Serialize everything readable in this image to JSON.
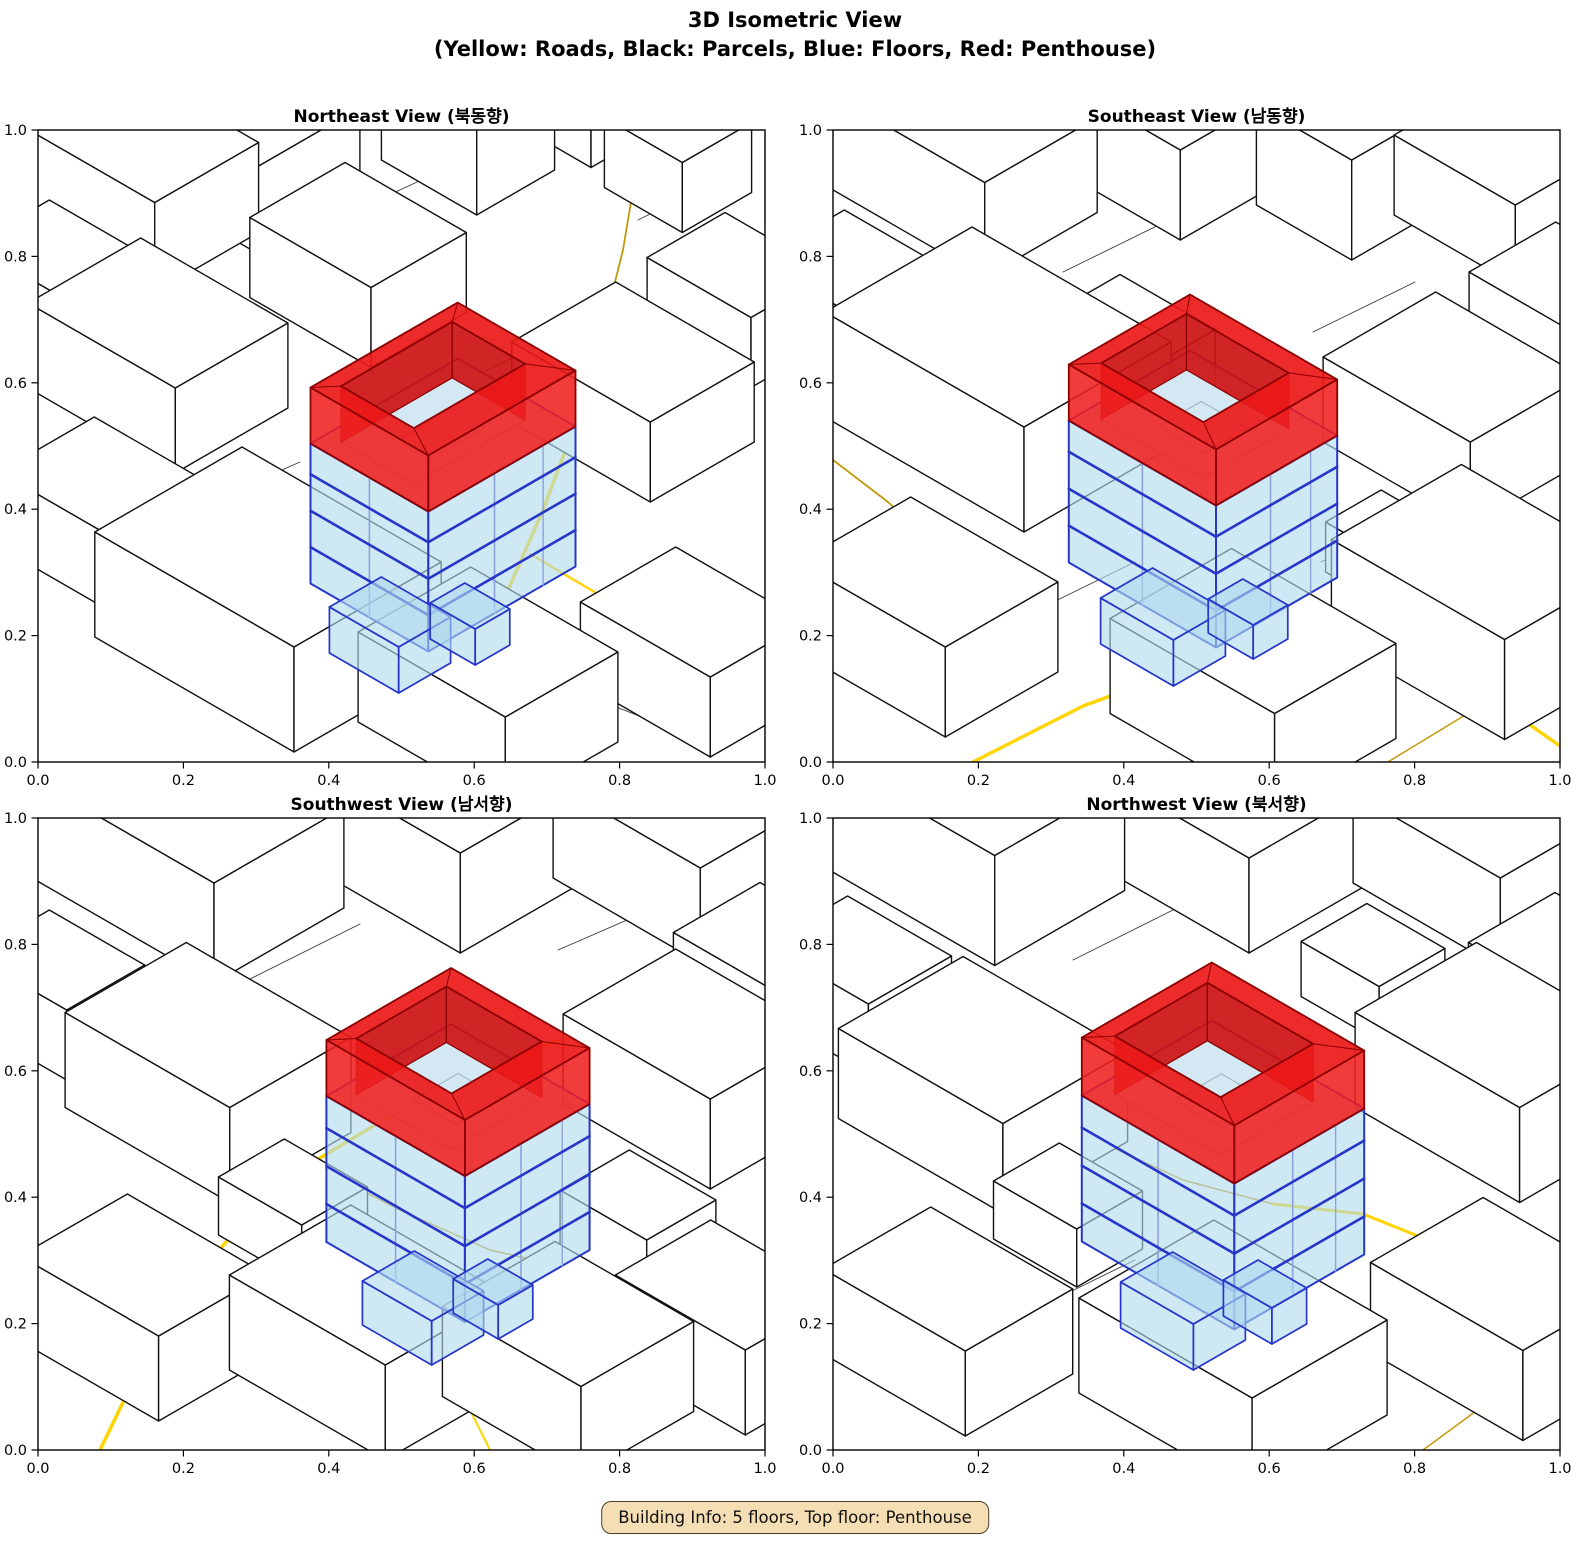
{
  "figure": {
    "title_line1": "3D Isometric View",
    "title_line2": "(Yellow: Roads, Black: Parcels, Blue: Floors, Red: Penthouse)",
    "info_box": "Building Info: 5 floors, Top floor: Penthouse"
  },
  "axes": {
    "x_ticks": [
      "0.0",
      "0.2",
      "0.4",
      "0.6",
      "0.8",
      "1.0"
    ],
    "y_ticks": [
      "0.0",
      "0.2",
      "0.4",
      "0.6",
      "0.8",
      "1.0"
    ]
  },
  "colors": {
    "bright_road": "#FFD400",
    "dark_road": "#C3990B",
    "parcel_line": "#3a3a3a",
    "building_fill": "#ffffff",
    "building_edge": "#111111",
    "blue_fill": "rgba(176,218,238,0.62)",
    "blue_top_fill": "rgba(199,228,242,0.75)",
    "blue_edge": "#2636C8",
    "blue_edge_light": "#8CA2DC",
    "hole_floor": "#D4E8F4",
    "interior_line": "#9AB0BF",
    "red_top": "rgba(235,25,25,0.92)",
    "red_wall": "rgba(240,32,32,0.88)",
    "red_inner": "rgba(205,18,18,0.92)",
    "red_edge": "#8B0000",
    "gray_arc": "#888888",
    "axis": "#000000",
    "info_bg": "#F5DEB3"
  },
  "views": [
    {
      "id": "ne",
      "title": "Northeast View (북동향)",
      "gray_arc": [
        [
          50,
          10
        ],
        [
          160,
          2
        ],
        [
          265,
          14
        ]
      ],
      "parcels": [
        [
          [
            250,
            112
          ],
          [
            392,
            46
          ]
        ],
        [
          [
            445,
            242
          ],
          [
            562,
            186
          ]
        ],
        [
          [
            150,
            382
          ],
          [
            262,
            332
          ]
        ],
        [
          [
            540,
            562
          ],
          [
            642,
            602
          ]
        ],
        [
          [
            600,
            90
          ],
          [
            660,
            60
          ]
        ]
      ],
      "roads": [
        {
          "c": "dark",
          "w": 1.8,
          "pts": [
            [
              600,
              30
            ],
            [
              585,
              120
            ],
            [
              560,
              220
            ],
            [
              535,
              300
            ]
          ]
        },
        {
          "c": "bright",
          "w": 3.5,
          "pts": [
            [
              535,
              300
            ],
            [
              505,
              380
            ],
            [
              470,
              460
            ],
            [
              435,
              540
            ],
            [
              405,
              610
            ],
            [
              392,
              632
            ]
          ]
        },
        {
          "c": "bright",
          "w": 2.4,
          "pts": [
            [
              492,
              424
            ],
            [
              570,
              470
            ],
            [
              660,
              516
            ],
            [
              727,
              546
            ]
          ]
        },
        {
          "c": "bright",
          "w": 2.4,
          "pts": [
            [
              24,
              14
            ],
            [
              58,
              52
            ]
          ]
        }
      ],
      "prisms": [
        [
          540,
          -15,
          60,
          45,
          80
        ],
        [
          205,
          55,
          75,
          60,
          85
        ],
        [
          95,
          90,
          85,
          60,
          90
        ],
        [
          430,
          35,
          55,
          45,
          95
        ],
        [
          640,
          60,
          45,
          40,
          70
        ],
        [
          320,
          175,
          70,
          55,
          80
        ],
        [
          20,
          185,
          55,
          45,
          65
        ],
        [
          700,
          205,
          60,
          45,
          70
        ],
        [
          120,
          268,
          85,
          65,
          85
        ],
        [
          595,
          302,
          80,
          60,
          80
        ],
        [
          65,
          422,
          65,
          55,
          75
        ],
        [
          230,
          522,
          115,
          85,
          105
        ],
        [
          450,
          602,
          85,
          65,
          90
        ],
        [
          655,
          562,
          75,
          55,
          80
        ]
      ],
      "building": {
        "g": [
          405,
          445
        ],
        "a": 68,
        "b": 85,
        "blueH": 140,
        "ringH": 56,
        "inset": 26,
        "holeOff": [
          -10,
          -4
        ],
        "floors": [
          0.26,
          0.52,
          0.78
        ],
        "annexes": [
          [
            352,
            528,
            40,
            30,
            46
          ],
          [
            432,
            512,
            26,
            20,
            36
          ]
        ]
      }
    },
    {
      "id": "se",
      "title": "Southeast View (남동향)",
      "parcels": [
        [
          [
            230,
            142
          ],
          [
            332,
            92
          ]
        ],
        [
          [
            480,
            202
          ],
          [
            582,
            152
          ]
        ],
        [
          [
            200,
            482
          ],
          [
            302,
            432
          ]
        ],
        [
          [
            488,
            432
          ],
          [
            562,
            396
          ]
        ]
      ],
      "roads": [
        {
          "c": "bright",
          "w": 3.0,
          "pts": [
            [
              350,
              6
            ],
            [
              480,
              32
            ],
            [
              610,
              48
            ],
            [
              727,
              52
            ]
          ]
        },
        {
          "c": "dark",
          "w": 1.8,
          "pts": [
            [
              0,
              330
            ],
            [
              55,
              372
            ],
            [
              115,
              426
            ],
            [
              170,
              482
            ]
          ]
        },
        {
          "c": "bright",
          "w": 3.4,
          "pts": [
            [
              140,
              632
            ],
            [
              250,
              576
            ],
            [
              370,
              532
            ],
            [
              480,
              516
            ],
            [
              580,
              532
            ],
            [
              670,
              576
            ],
            [
              727,
              616
            ]
          ]
        },
        {
          "c": "dark",
          "w": 1.5,
          "pts": [
            [
              555,
              632
            ],
            [
              670,
              562
            ],
            [
              727,
              536
            ]
          ]
        }
      ],
      "prisms": [
        [
          330,
          45,
          75,
          55,
          90
        ],
        [
          130,
          70,
          90,
          65,
          95
        ],
        [
          510,
          80,
          55,
          45,
          100
        ],
        [
          665,
          95,
          70,
          50,
          80
        ],
        [
          20,
          205,
          60,
          50,
          70
        ],
        [
          300,
          252,
          55,
          40,
          60
        ],
        [
          740,
          232,
          70,
          50,
          80
        ],
        [
          165,
          302,
          115,
          85,
          105
        ],
        [
          620,
          322,
          85,
          65,
          85
        ],
        [
          555,
          446,
          40,
          32,
          50
        ],
        [
          650,
          522,
          100,
          75,
          100
        ],
        [
          95,
          532,
          85,
          65,
          90
        ],
        [
          420,
          596,
          95,
          70,
          95
        ]
      ],
      "building": {
        "g": [
          370,
          440
        ],
        "a": 85,
        "b": 70,
        "blueH": 142,
        "ringH": 56,
        "inset": 26,
        "holeOff": [
          -8,
          -4
        ],
        "floors": [
          0.26,
          0.52,
          0.78
        ],
        "annexes": [
          [
            330,
            520,
            42,
            30,
            46
          ],
          [
            415,
            506,
            26,
            20,
            34
          ]
        ]
      }
    },
    {
      "id": "sw",
      "title": "Southwest View (남서향)",
      "parcels": [
        [
          [
            210,
            162
          ],
          [
            322,
            106
          ]
        ],
        [
          [
            520,
            132
          ],
          [
            612,
            92
          ]
        ],
        [
          [
            180,
            472
          ],
          [
            282,
            422
          ]
        ],
        [
          [
            560,
            482
          ],
          [
            652,
            522
          ]
        ]
      ],
      "roads": [
        {
          "c": "bright",
          "w": 2.2,
          "pts": [
            [
              698,
              18
            ],
            [
              727,
              44
            ]
          ]
        },
        {
          "c": "dark",
          "w": 1.5,
          "pts": [
            [
              272,
              346
            ],
            [
              362,
              392
            ],
            [
              452,
              432
            ],
            [
              540,
              452
            ]
          ]
        },
        {
          "c": "bright",
          "w": 3.5,
          "pts": [
            [
              62,
              632
            ],
            [
              116,
              520
            ],
            [
              186,
              426
            ],
            [
              272,
              346
            ],
            [
              372,
              286
            ],
            [
              482,
              236
            ],
            [
              602,
              196
            ],
            [
              727,
              168
            ]
          ]
        },
        {
          "c": "bright",
          "w": 2.0,
          "pts": [
            [
              422,
              572
            ],
            [
              452,
              632
            ]
          ]
        }
      ],
      "prisms": [
        [
          405,
          55,
          90,
          70,
          100
        ],
        [
          150,
          75,
          105,
          75,
          100
        ],
        [
          645,
          70,
          85,
          65,
          95
        ],
        [
          20,
          212,
          55,
          45,
          70
        ],
        [
          735,
          202,
          65,
          50,
          80
        ],
        [
          170,
          302,
          95,
          70,
          95
        ],
        [
          655,
          296,
          85,
          65,
          90
        ],
        [
          255,
          422,
          48,
          38,
          58
        ],
        [
          600,
          432,
          50,
          40,
          55
        ],
        [
          105,
          532,
          80,
          62,
          85
        ],
        [
          330,
          562,
          90,
          70,
          95
        ],
        [
          530,
          586,
          80,
          65,
          90
        ],
        [
          690,
          552,
          75,
          55,
          85
        ]
      ],
      "building": {
        "g": [
          420,
          428
        ],
        "a": 80,
        "b": 72,
        "blueH": 146,
        "ringH": 56,
        "inset": 25,
        "holeOff": [
          -9,
          -4
        ],
        "floors": [
          0.26,
          0.52,
          0.78
        ],
        "annexes": [
          [
            385,
            512,
            40,
            30,
            44
          ],
          [
            455,
            498,
            26,
            20,
            34
          ]
        ]
      }
    },
    {
      "id": "nw",
      "title": "Northwest View (북서향)",
      "parcels": [
        [
          [
            240,
            142
          ],
          [
            352,
            86
          ]
        ],
        [
          [
            500,
            182
          ],
          [
            602,
            132
          ]
        ],
        [
          [
            200,
            492
          ],
          [
            302,
            442
          ]
        ],
        [
          [
            555,
            502
          ],
          [
            642,
            542
          ]
        ]
      ],
      "roads": [
        {
          "c": "bright",
          "w": 2.0,
          "pts": [
            [
              0,
              196
            ],
            [
              75,
              226
            ],
            [
              150,
              266
            ]
          ]
        },
        {
          "c": "dark",
          "w": 1.5,
          "pts": [
            [
              150,
              266
            ],
            [
              250,
              316
            ],
            [
              350,
              362
            ],
            [
              440,
              386
            ]
          ]
        },
        {
          "c": "bright",
          "w": 3.0,
          "pts": [
            [
              440,
              386
            ],
            [
              530,
              396
            ],
            [
              620,
              432
            ],
            [
              700,
              472
            ],
            [
              727,
              492
            ]
          ]
        },
        {
          "c": "dark",
          "w": 1.5,
          "pts": [
            [
              590,
              632
            ],
            [
              680,
              566
            ],
            [
              727,
              542
            ]
          ]
        }
      ],
      "prisms": [
        [
          390,
          45,
          105,
          75,
          95
        ],
        [
          140,
          60,
          100,
          75,
          110
        ],
        [
          650,
          75,
          85,
          65,
          90
        ],
        [
          25,
          202,
          60,
          48,
          70
        ],
        [
          735,
          212,
          65,
          50,
          80
        ],
        [
          540,
          182,
          45,
          38,
          55
        ],
        [
          150,
          312,
          95,
          72,
          90
        ],
        [
          665,
          302,
          95,
          70,
          95
        ],
        [
          235,
          426,
          48,
          38,
          58
        ],
        [
          115,
          546,
          82,
          62,
          85
        ],
        [
          400,
          586,
          100,
          78,
          95
        ],
        [
          670,
          546,
          88,
          65,
          90
        ]
      ],
      "building": {
        "g": [
          390,
          430
        ],
        "a": 88,
        "b": 75,
        "blueH": 146,
        "ringH": 58,
        "inset": 27,
        "holeOff": [
          -9,
          -4
        ],
        "floors": [
          0.26,
          0.52,
          0.78
        ],
        "annexes": [
          [
            350,
            516,
            42,
            30,
            46
          ],
          [
            432,
            502,
            28,
            20,
            36
          ]
        ]
      }
    }
  ]
}
